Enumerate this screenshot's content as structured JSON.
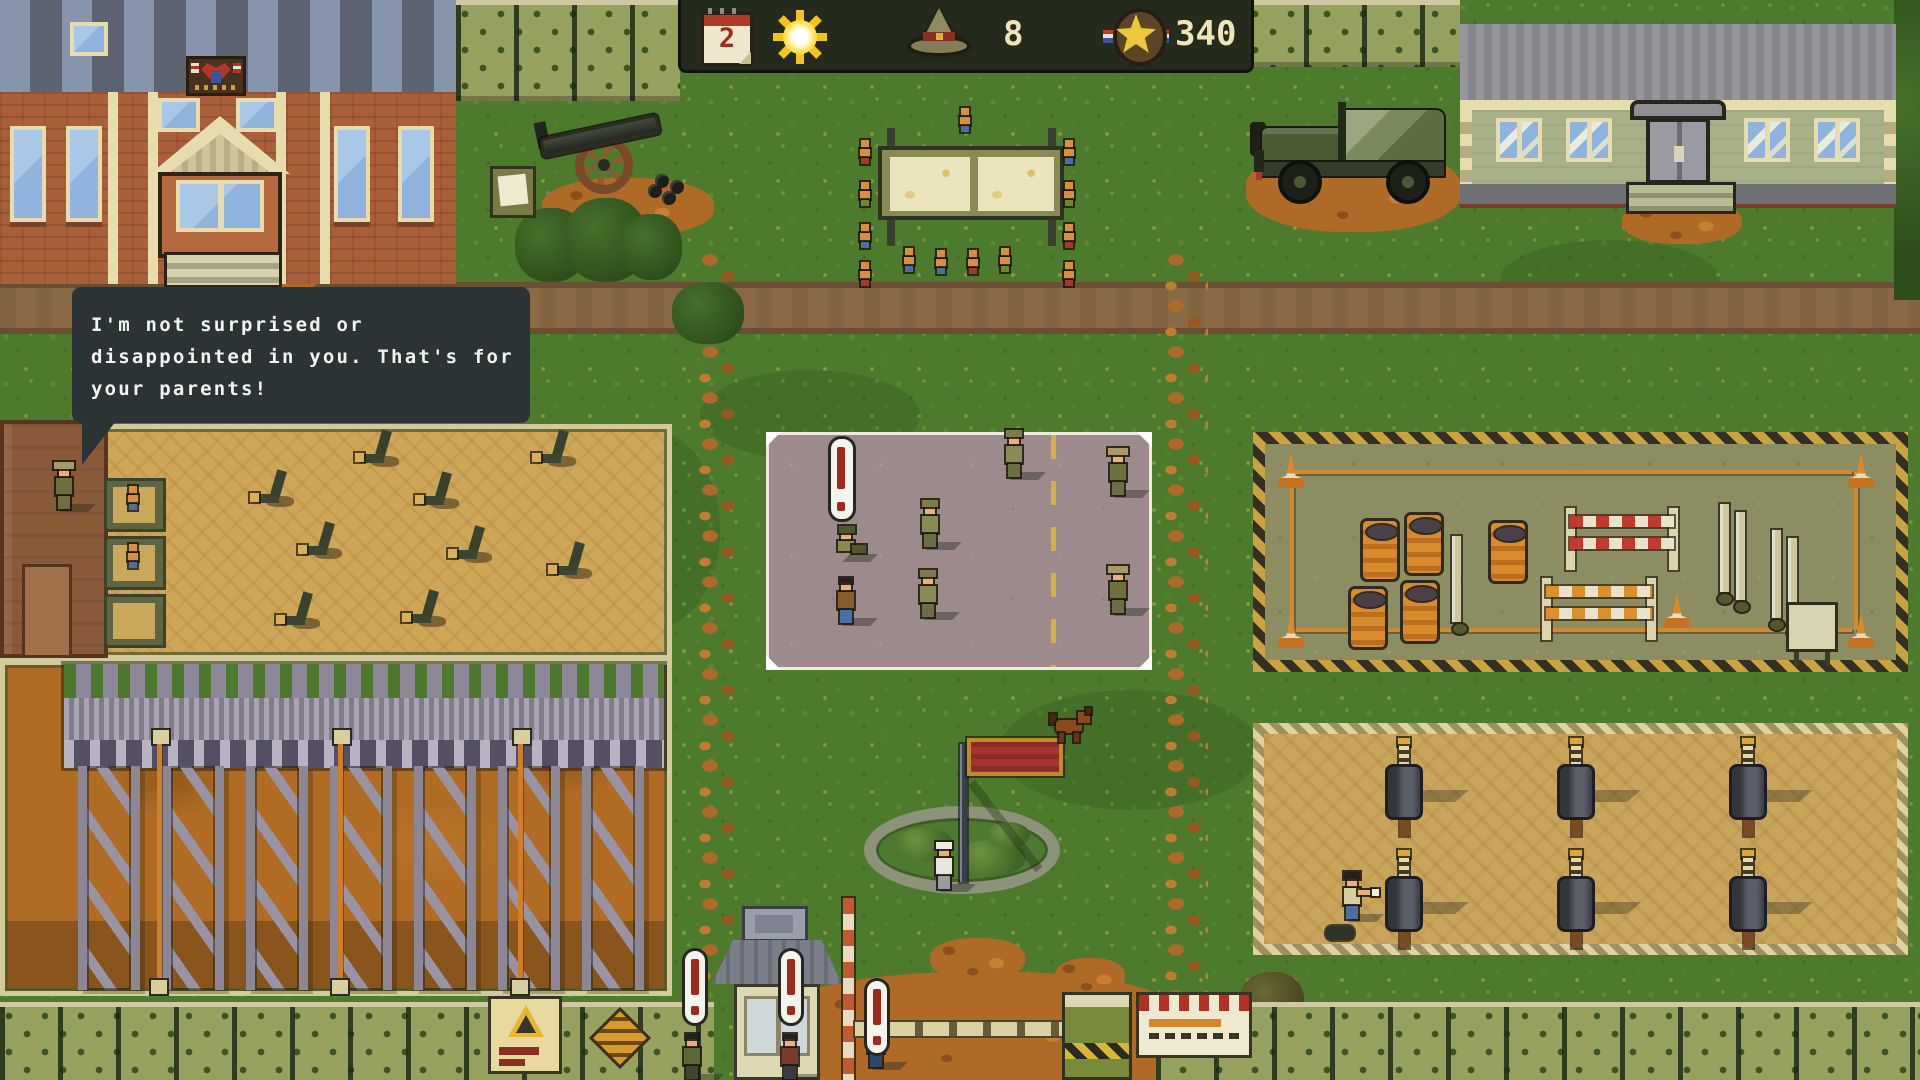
{
  "hud": {
    "day": "2",
    "drill_instructors": "8",
    "merit_points": "340",
    "icons": {
      "calendar": "calendar-icon",
      "weather": "sun-icon",
      "instructor": "campaign-hat-icon",
      "merit": "star-medal-icon"
    }
  },
  "speech_bubble": {
    "lines": [
      "I'm not surprised or",
      "disappointed in you. That's for",
      "your parents!"
    ]
  },
  "palette": {
    "grass": "#4e7a2e",
    "road": "#8a6a45",
    "dirt": "#b06a28",
    "sand": "#cda65a",
    "hud_bg": "#252b1c",
    "hud_text": "#efe3b7",
    "speech_bg": "#2b3334",
    "alert_red": "#9e2a22",
    "flag_red": "#a83430"
  }
}
